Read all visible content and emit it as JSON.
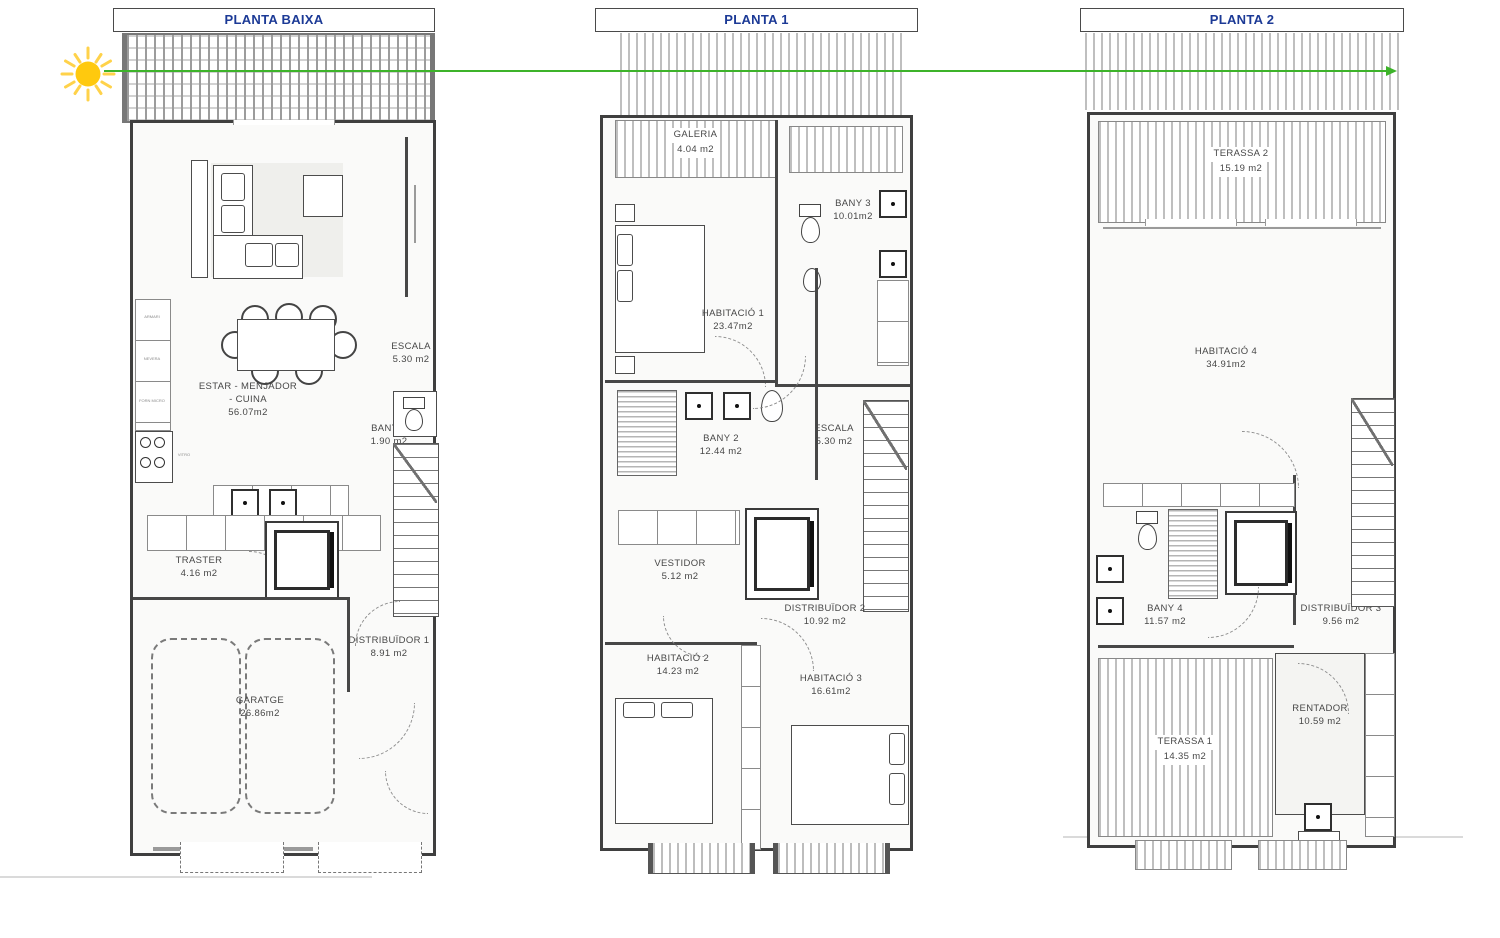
{
  "sheet": {
    "type": "architectural-floor-plans",
    "orientation_arrow_color": "#3db32a",
    "sun_color": "#ffc90e",
    "title_color": "#1c3a96",
    "wall_color": "#3f3f3f"
  },
  "floors": [
    {
      "title": "PLANTA BAIXA",
      "rooms": [
        {
          "name": "ESTAR - MENJADOR",
          "name2": "- CUINA",
          "area": "56.07m2"
        },
        {
          "name": "ESCALA",
          "area": "5.30 m2"
        },
        {
          "name": "BANY 1",
          "area": "1.90 m2"
        },
        {
          "name": "TRASTER",
          "area": "4.16 m2"
        },
        {
          "name": "DISTRIBUÏDOR 1",
          "area": "8.91 m2"
        },
        {
          "name": "GARATGE",
          "area": "26.86m2"
        }
      ],
      "small_labels": [
        "ARMARI",
        "NEVERA",
        "FORN MICRO",
        "VITRO"
      ]
    },
    {
      "title": "PLANTA 1",
      "rooms": [
        {
          "name": "GALERIA",
          "area": "4.04 m2"
        },
        {
          "name": "BANY 3",
          "area": "10.01m2"
        },
        {
          "name": "HABITACIÓ 1",
          "area": "23.47m2"
        },
        {
          "name": "BANY 2",
          "area": "12.44 m2"
        },
        {
          "name": "ESCALA",
          "area": "5.30 m2"
        },
        {
          "name": "VESTIDOR",
          "area": "5.12 m2"
        },
        {
          "name": "DISTRIBUÏDOR 2",
          "area": "10.92 m2"
        },
        {
          "name": "HABITACIÓ 2",
          "area": "14.23 m2"
        },
        {
          "name": "HABITACIÓ 3",
          "area": "16.61m2"
        }
      ]
    },
    {
      "title": "PLANTA 2",
      "rooms": [
        {
          "name": "TERASSA 2",
          "area": "15.19 m2"
        },
        {
          "name": "HABITACIÓ 4",
          "area": "34.91m2"
        },
        {
          "name": "BANY 4",
          "area": "11.57 m2"
        },
        {
          "name": "DISTRIBUÏDOR 3",
          "area": "9.56 m2"
        },
        {
          "name": "RENTADOR",
          "area": "10.59 m2"
        },
        {
          "name": "TERASSA 1",
          "area": "14.35 m2"
        }
      ]
    }
  ]
}
